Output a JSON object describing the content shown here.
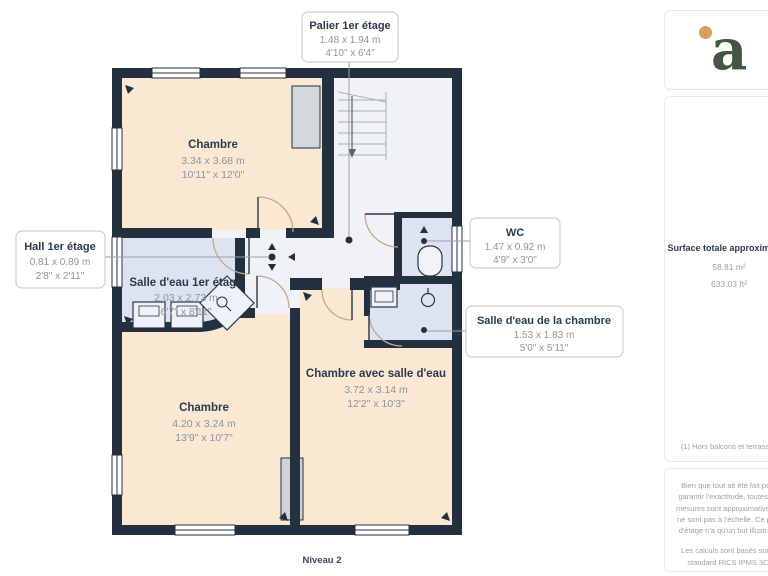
{
  "plan": {
    "level": "Niveau 2",
    "rooms": [
      {
        "name": "Chambre",
        "metric": "3.34 x 3.68 m",
        "imperial": "10'11\" x 12'0\""
      },
      {
        "name": "Salle d'eau 1er étage",
        "metric": "2.03 x 2.73 m",
        "imperial": "6'7\" x 8'11\""
      },
      {
        "name": "Chambre",
        "metric": "4.20 x 3.24 m",
        "imperial": "13'9\" x 10'7\""
      },
      {
        "name": "Chambre avec salle d'eau",
        "metric": "3.72 x 3.14 m",
        "imperial": "12'2\" x 10'3\""
      }
    ],
    "callouts": [
      {
        "name": "Palier 1er étage",
        "metric": "1.48 x 1.94 m",
        "imperial": "4'10\" x 6'4\""
      },
      {
        "name": "Hall 1er étage",
        "metric": "0.81 x 0.89 m",
        "imperial": "2'8\" x 2'11\""
      },
      {
        "name": "WC",
        "metric": "1.47 x 0.92 m",
        "imperial": "4'9\" x 3'0\""
      },
      {
        "name": "Salle d'eau de la chambre",
        "metric": "1.53 x 1.83 m",
        "imperial": "5'0\" x 5'11\""
      }
    ],
    "colors": {
      "wall": "#22303f",
      "bedroom_fill": "#fae8d3",
      "wet_room_fill": "#dde3f0",
      "hall_fill": "#f1f2f6"
    }
  },
  "sidebar": {
    "logo_letter": "a",
    "logo_colors": {
      "letter_green": "#42573f",
      "dot_orange": "#d89f60"
    },
    "surface_title": "Surface totale approximative",
    "surface_m2": "58.81 m²",
    "surface_ft2": "633.03 ft²",
    "footnote": "(1) Hors balcons et terrasses",
    "disclaimer_1": "Bien que tout ait été fait pour garantir l'exactitude, toutes les mesures sont approximatives et ne sont pas à l'échelle. Ce plan d'étage n'a qu'un but illustratif.",
    "disclaimer_2": "Les calculs sont basés sur le standard RICS IPMS 3C.",
    "brand": "GIRAFFE",
    "brand_suffix": "360"
  }
}
